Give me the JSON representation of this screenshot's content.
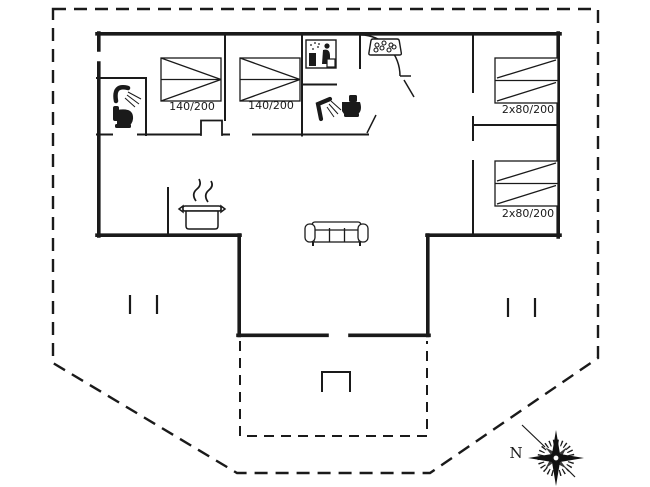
{
  "plan_title": "holiday-house-floor-plan",
  "beds": [
    {
      "id": "double-bed-1",
      "label": "140/200"
    },
    {
      "id": "double-bed-2",
      "label": "140/200"
    },
    {
      "id": "bunk-bed-1",
      "label": "2x80/200"
    },
    {
      "id": "bunk-bed-2",
      "label": "2x80/200"
    }
  ],
  "compass": {
    "label": "N"
  },
  "icons": [
    "shower-icon",
    "toilet-icon",
    "sauna-icon",
    "whirlpool-icon",
    "cooking-pot-icon",
    "sofa-icon",
    "compass-rose-icon"
  ],
  "colors": {
    "line": "#1a1a1a",
    "background": "#ffffff"
  }
}
